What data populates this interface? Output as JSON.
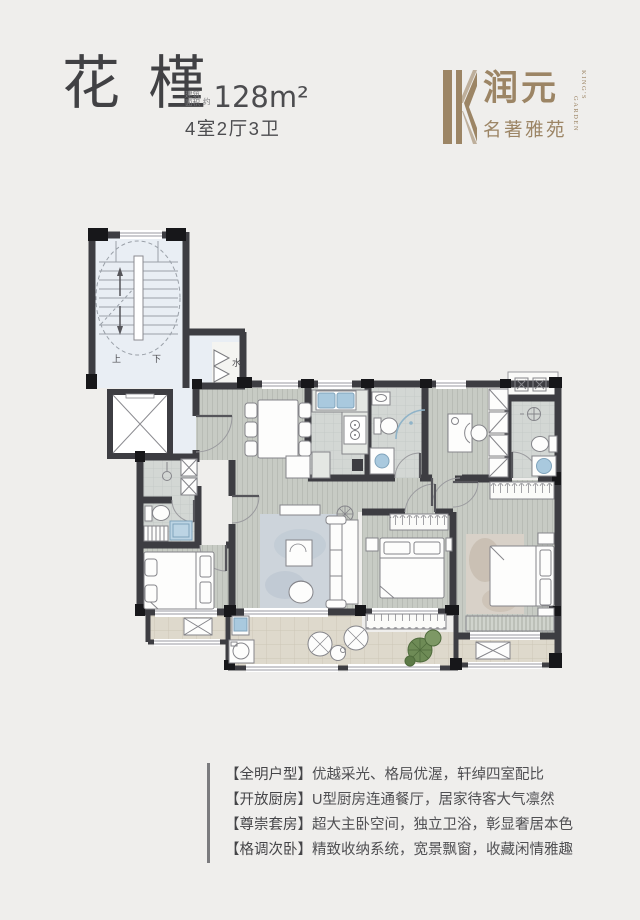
{
  "header": {
    "title": "花槿",
    "area_label_line1": "建筑",
    "area_label_line2": "面积",
    "area_approx": "约",
    "area_value": "128m²",
    "layout_spec": "4室2厅3卫"
  },
  "logo": {
    "name_cn": "润元",
    "subtitle_cn": "名著雅苑",
    "name_en": "KING'S",
    "subtitle_en": "GARDEN",
    "gold": "#9c8565"
  },
  "floorplan": {
    "labels": {
      "up": "上",
      "down": "下",
      "water": "水"
    },
    "colors": {
      "wall": "#3d3d42",
      "wood_floor": "#c7cbc4",
      "tile_floor": "#d3d7d4",
      "balcony_floor": "#ded9cc",
      "lobby_floor": "#e9eef4",
      "fixture_blue": "#a9c9de",
      "plant_green": "#6e8b56"
    }
  },
  "features": [
    {
      "tag": "【全明户型】",
      "text": "优越采光、格局优渥，轩绰四室配比"
    },
    {
      "tag": "【开放厨房】",
      "text": "U型厨房连通餐厅，居家待客大气凛然"
    },
    {
      "tag": "【尊崇套房】",
      "text": "超大主卧空间，独立卫浴，彰显奢居本色"
    },
    {
      "tag": "【格调次卧】",
      "text": "精致收纳系统，宽景飘窗，收藏闲情雅趣"
    }
  ]
}
